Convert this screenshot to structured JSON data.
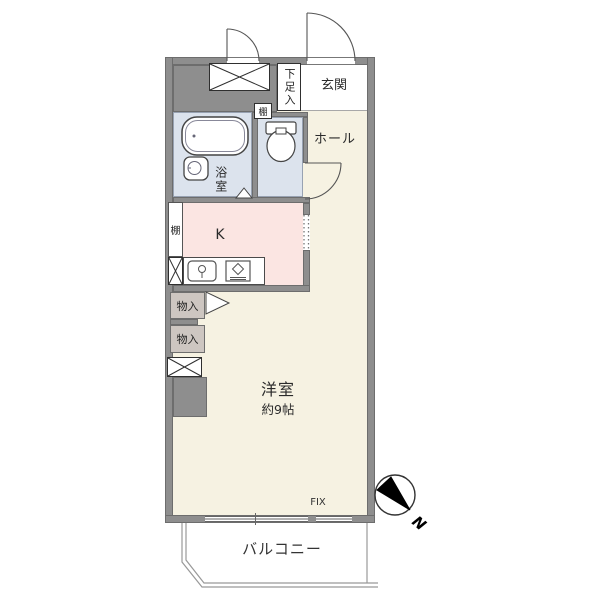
{
  "plan": {
    "rooms": {
      "genkan": "玄関",
      "hall": "ホール",
      "bathroom": "浴室",
      "kitchen": "K",
      "living": "洋室",
      "living_size": "約9帖",
      "balcony": "バルコニー"
    },
    "storage": {
      "shoe_cabinet": "下足入",
      "shelf_upper": "棚",
      "shelf_kitchen": "棚",
      "closet_upper": "物入",
      "closet_lower": "物入"
    },
    "annotations": {
      "fix_window": "FIX",
      "north": "N"
    },
    "colors": {
      "wall": "#8e8e8e",
      "wet_area": "#dce3ed",
      "kitchen": "#fbe5e2",
      "living": "#f6f2e2",
      "closet": "#cdc6c1",
      "accent_line": "#6d6d6d"
    }
  }
}
